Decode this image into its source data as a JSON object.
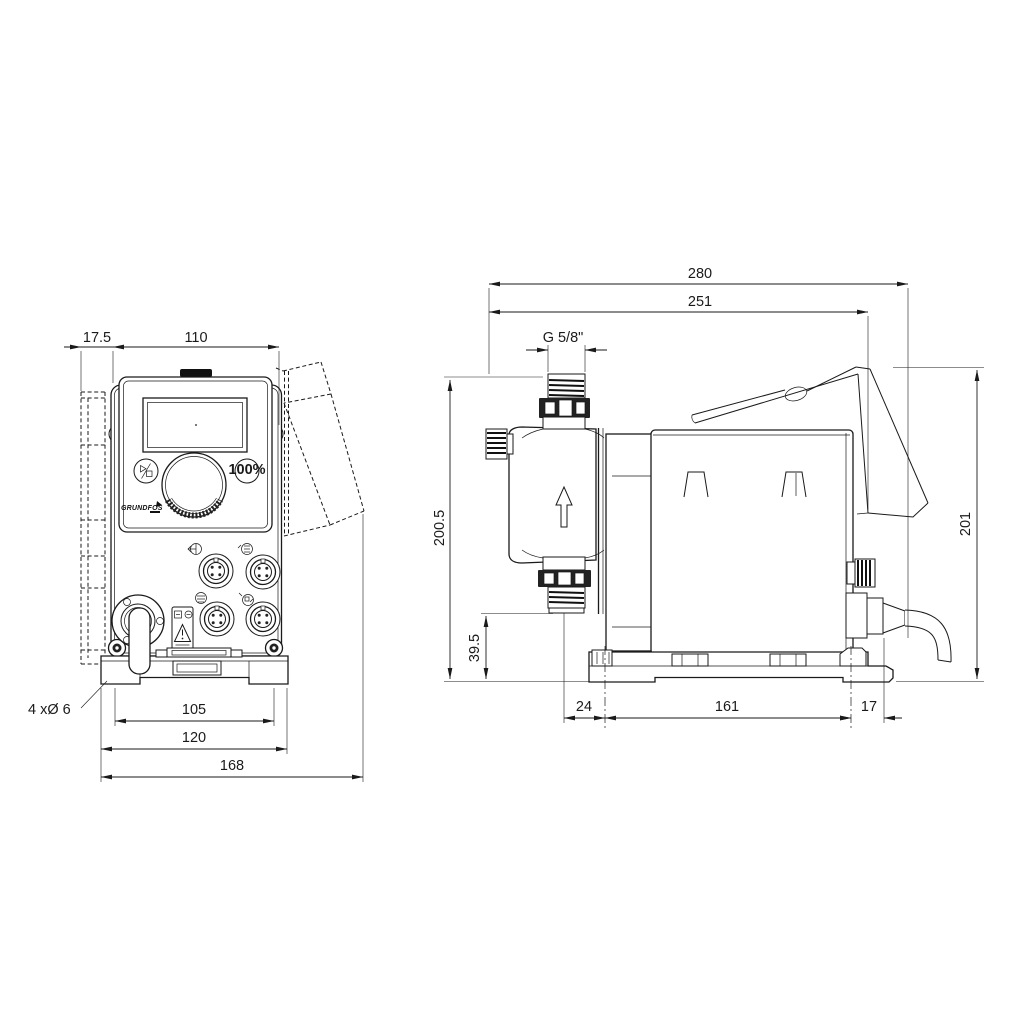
{
  "colors": {
    "line": "#1a1a1a",
    "background": "#ffffff"
  },
  "front": {
    "dims": {
      "offset": "17.5",
      "width": "110",
      "holes": "105",
      "plate": "120",
      "total": "168"
    },
    "note": "4 xØ 6",
    "panel": {
      "btn100": "100%",
      "logo": "GRUNDFOS"
    }
  },
  "side": {
    "dims": {
      "total_depth": "280",
      "bracket_depth": "251",
      "thread": "G 5/8\"",
      "h_top": "200.5",
      "h_bottom": "39.5",
      "h_total": "201",
      "front": "24",
      "base": "161",
      "rear": "17"
    }
  }
}
